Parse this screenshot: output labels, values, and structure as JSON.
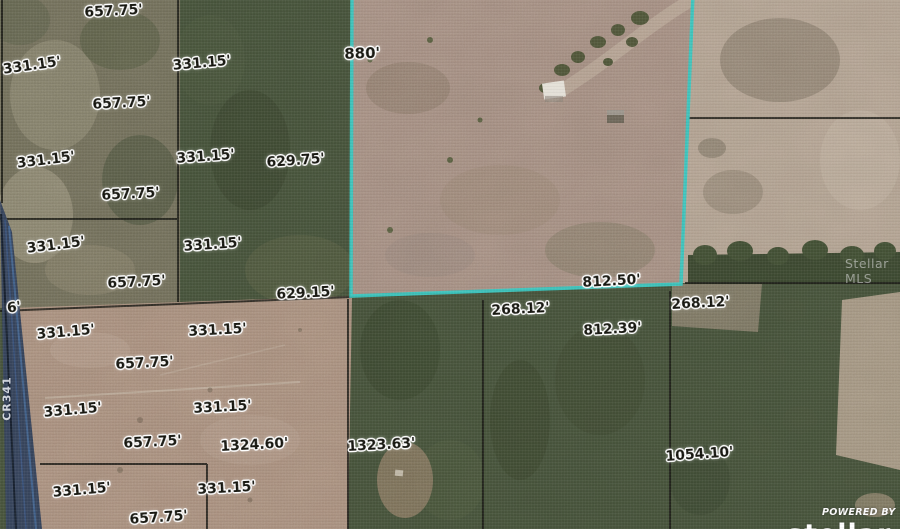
{
  "window": {
    "width": 900,
    "height": 529,
    "content": "aerial parcel map with lot dimension overlays"
  },
  "colors": {
    "highlight_teal": "#38c7c1",
    "forest_green": "#45513a",
    "field_tan": "#a58e82",
    "road_blue": "#466c9e",
    "label_ink": "#16160f"
  },
  "labels": [
    {
      "text": "657.75'"
    },
    {
      "text": "331.15'"
    },
    {
      "text": "331.15'"
    },
    {
      "text": "657.75'"
    },
    {
      "text": "331.15'"
    },
    {
      "text": "331.15'"
    },
    {
      "text": "629.75'"
    },
    {
      "text": "657.75'"
    },
    {
      "text": "880'"
    },
    {
      "text": "331.15'"
    },
    {
      "text": "331.15'"
    },
    {
      "text": "657.75'"
    },
    {
      "text": "629.15'"
    },
    {
      "text": "812.50'"
    },
    {
      "text": "268.12'"
    },
    {
      "text": "268.12'"
    },
    {
      "text": "812.39'"
    },
    {
      "text": "6'"
    },
    {
      "text": "331.15'"
    },
    {
      "text": "331.15'"
    },
    {
      "text": "657.75'"
    },
    {
      "text": "331.15'"
    },
    {
      "text": "331.15'"
    },
    {
      "text": "657.75'"
    },
    {
      "text": "1324.60'"
    },
    {
      "text": "1323.63'"
    },
    {
      "text": "331.15'"
    },
    {
      "text": "331.15'"
    },
    {
      "text": "657.75'"
    },
    {
      "text": "1054.10'"
    }
  ],
  "road": {
    "name": "CR341"
  },
  "watermark": {
    "text": "Stellar MLS"
  },
  "branding": {
    "powered_by": "POWERED BY",
    "logo_text_partial": "stellar"
  }
}
